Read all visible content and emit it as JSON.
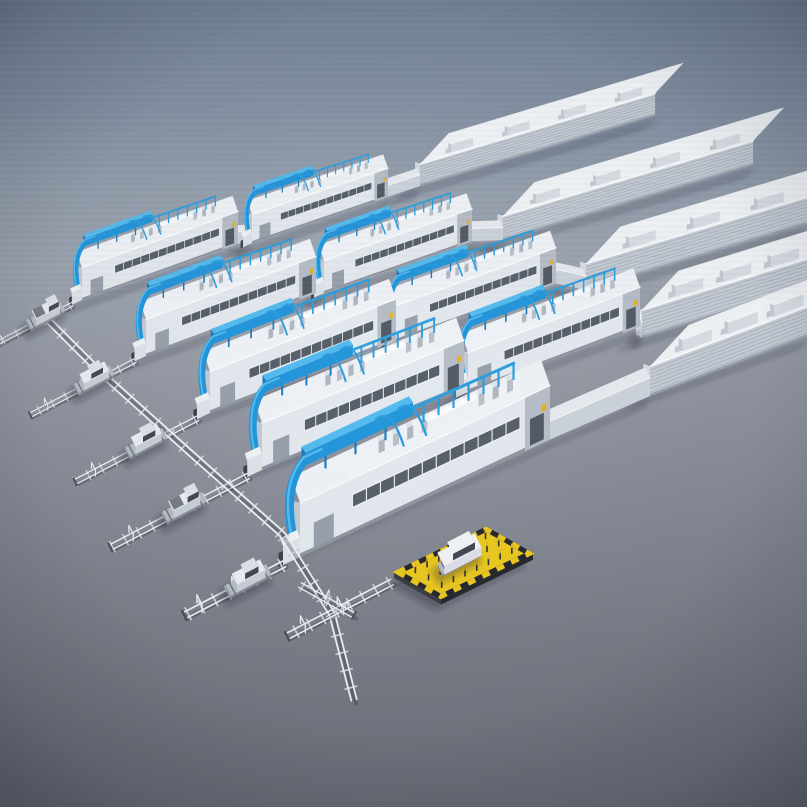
{
  "meta": {
    "kind": "3d-render",
    "subject": "Isometric 3D render of a modular automotive paint-shop factory complex",
    "elements": "Five diagonal production lines of white modular buildings with blue rooftop duct equipment, large flat warehouse halls with rooftop HVAC units at the upper right, floor-level transfer rails with vehicle shuttles at the lower left, and a yellow loading platform with a car at the front"
  },
  "palette": {
    "bg_top": "#6f7e93",
    "bg_mid": "#97a0ac",
    "bg_floor": "#7e828d",
    "bg_bottom": "#686c76",
    "module_front": "#e3e8ee",
    "module_end": "#c3cad3",
    "module_top": "#eef1f5",
    "module_trim": "#8e95a0",
    "module_annex": "#b6bdc7",
    "window_dark": "#58606b",
    "window_frame": "#f0f3f6",
    "door_gray": "#98a0ab",
    "gear_front": "#b9c0ca",
    "gear_top": "#e0e5eb",
    "container_front": "#eef1f4",
    "container_top": "#fafbfd",
    "blue_top": "#55bbee",
    "blue_front": "#2496da",
    "blue_dark": "#1a7dbd",
    "blue_pipe": "#2d9fdd",
    "warehouse_front": "#c5ccd5",
    "warehouse_rib": "#aeb5bf",
    "warehouse_top": "#f0f3f6",
    "warehouse_end": "#d6dbe2",
    "roofbox_front": "#d8dde4",
    "roofbox_top": "#f2f4f7",
    "roofbox_end": "#c4cbd4",
    "corridor_front": "#ccd2da",
    "corridor_top": "#e6eaef",
    "vestibule_front": "#dde2e8",
    "vestibule_top": "#eff2f5",
    "vestibule_door": "#3d434d",
    "rail_lite": "#eceff3",
    "rail_shadow": "#6f747e",
    "sleeper": "#c9ced6",
    "buffer_stop": "#4c525c",
    "sled_base": "#878d98",
    "sled_top": "#b5bbc4",
    "car_side": "#c9ced6",
    "car_top": "#e8ebef",
    "car_end": "#aeb4be",
    "glass": "#424954",
    "car_roof": "#dde1e7",
    "bed_dark": "#777d88",
    "suv_side": "#dce0e6",
    "suv_top": "#f0f2f6",
    "platform_yellow": "#eac821",
    "platform_black": "#26292e",
    "platform_side": "#3a3e45",
    "safety_yellow": "#e2b32a",
    "shadow": "rgba(28,32,41,0.30)"
  },
  "background": {
    "stops": [
      [
        "0%",
        "#6f7e93"
      ],
      [
        "12%",
        "#7d8b9e"
      ],
      [
        "24%",
        "#909aa8"
      ],
      [
        "34%",
        "#98a0ac"
      ],
      [
        "48%",
        "#8e929d"
      ],
      [
        "64%",
        "#818590"
      ],
      [
        "82%",
        "#747882"
      ],
      [
        "100%",
        "#686c76"
      ]
    ]
  },
  "scene": {
    "rows": [
      {
        "name": "production-line-1",
        "modules": [
          {
            "anchor": [
              82,
              300
            ],
            "width": 156,
            "slope": 0.36,
            "scale": 0.6
          },
          {
            "anchor": [
              252,
              243
            ],
            "width": 136,
            "slope": 0.34,
            "scale": 0.53
          }
        ],
        "warehouse": {
          "anchor": [
            420,
            186
          ],
          "width": 235,
          "slope": 0.3,
          "scale": 0.55,
          "roof_units": 4
        },
        "track_len": 95,
        "vehicle": {
          "type": "pickup",
          "dist": 30
        }
      },
      {
        "name": "production-line-2",
        "modules": [
          {
            "anchor": [
              146,
              356
            ],
            "width": 170,
            "slope": 0.37,
            "scale": 0.68
          },
          {
            "anchor": [
              324,
              293
            ],
            "width": 148,
            "slope": 0.35,
            "scale": 0.6
          }
        ],
        "warehouse": {
          "anchor": [
            503,
            240
          ],
          "width": 250,
          "slope": 0.3,
          "scale": 0.6,
          "roof_units": 4
        },
        "track_len": 118,
        "vehicle": {
          "type": "sedan",
          "dist": 46
        }
      },
      {
        "name": "production-line-3",
        "modules": [
          {
            "anchor": [
              210,
              413
            ],
            "width": 186,
            "slope": 0.39,
            "scale": 0.77
          },
          {
            "anchor": [
              396,
              341
            ],
            "width": 160,
            "slope": 0.36,
            "scale": 0.66
          }
        ],
        "warehouse": {
          "anchor": [
            586,
            290
          ],
          "width": 221,
          "slope": 0.3,
          "scale": 0.66,
          "roof_units": 3
        },
        "track_len": 138,
        "vehicle": {
          "type": "sedan",
          "dist": 58
        }
      },
      {
        "name": "production-line-4",
        "modules": [
          {
            "anchor": [
              262,
              470
            ],
            "width": 202,
            "slope": 0.41,
            "scale": 0.87
          },
          {
            "anchor": [
              468,
              392
            ],
            "width": 172,
            "slope": 0.38,
            "scale": 0.73
          }
        ],
        "warehouse": {
          "anchor": [
            642,
            338
          ],
          "width": 165,
          "slope": 0.31,
          "scale": 0.7,
          "roof_units": 3
        },
        "track_len": 155,
        "vehicle": {
          "type": "pickup",
          "dist": 72
        }
      },
      {
        "name": "production-line-5",
        "modules": [
          {
            "anchor": [
              300,
              557
            ],
            "width": 250,
            "slope": 0.47,
            "scale": 1.0
          }
        ],
        "warehouse": {
          "anchor": [
            650,
            396
          ],
          "width": 158,
          "slope": 0.38,
          "scale": 0.74,
          "roof_units": 3
        },
        "track_len": 112,
        "vehicle": {
          "type": "sedan",
          "dist": 40
        }
      }
    ],
    "transfer_line": {
      "points": [
        [
          46,
          318
        ],
        [
          100,
          372
        ],
        [
          196,
          458
        ],
        [
          282,
          534
        ],
        [
          332,
          614
        ],
        [
          354,
          700
        ]
      ]
    },
    "feeder_track": {
      "start": [
        392,
        582
      ],
      "len": 118
    },
    "junction_stub": {
      "start": [
        300,
        585
      ],
      "len": 62
    },
    "loading_platform": {
      "anchor": [
        394,
        578
      ],
      "length": 104,
      "depth": 54,
      "vehicle": "suv"
    },
    "counts": {
      "production_lines": 5,
      "paint_modules": 9,
      "warehouse_buildings": 5,
      "shuttle_vehicles": 5,
      "platform_vehicles": 1
    }
  }
}
